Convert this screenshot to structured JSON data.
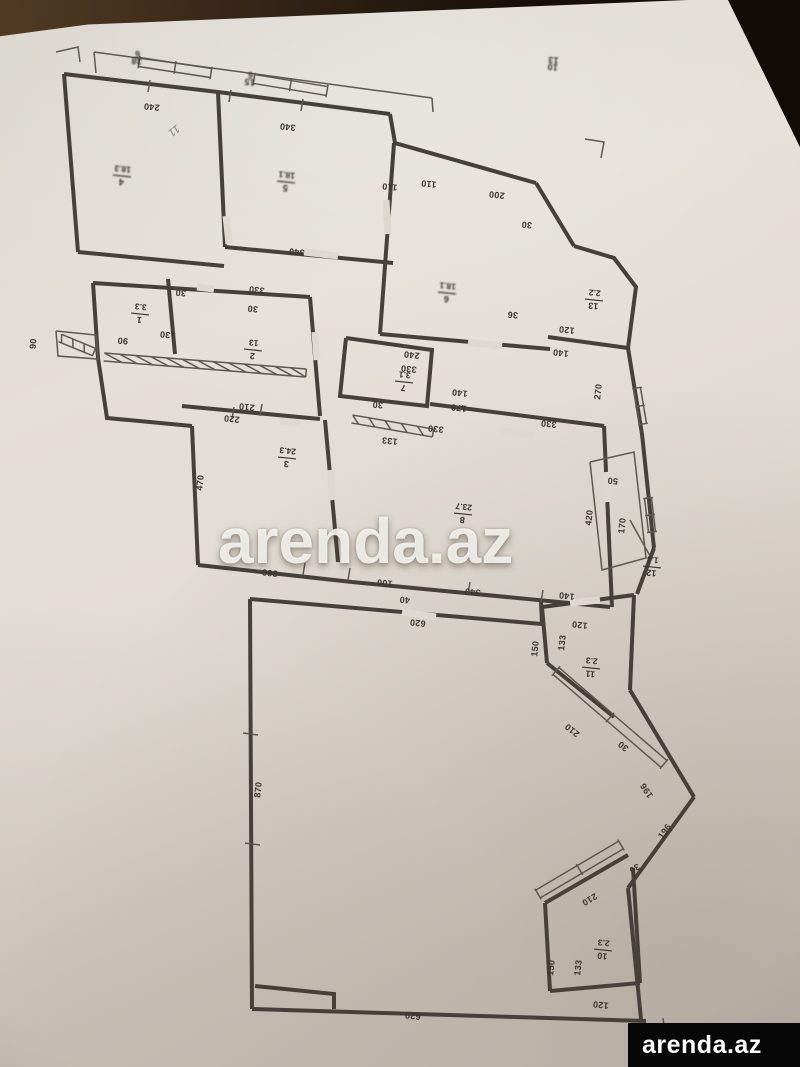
{
  "watermark": {
    "text": "arenda.az"
  },
  "logo": {
    "text": "arenda.az"
  },
  "plan": {
    "ink": "#45413a",
    "walls_thick": [
      [
        [
          64,
          74
        ],
        [
          218,
          92
        ],
        [
          390,
          114
        ]
      ],
      [
        [
          390,
          114
        ],
        [
          395,
          143
        ],
        [
          536,
          183
        ]
      ],
      [
        [
          536,
          183
        ],
        [
          574,
          246
        ]
      ],
      [
        [
          574,
          246
        ],
        [
          614,
          258
        ],
        [
          636,
          287
        ],
        [
          628,
          348
        ],
        [
          548,
          337
        ]
      ],
      [
        [
          628,
          348
        ],
        [
          642,
          434
        ],
        [
          654,
          548
        ]
      ],
      [
        [
          654,
          548
        ],
        [
          637,
          594
        ]
      ],
      [
        [
          218,
          92
        ],
        [
          225,
          247
        ]
      ],
      [
        [
          64,
          74
        ],
        [
          78,
          252
        ]
      ],
      [
        [
          78,
          252
        ],
        [
          224,
          266
        ]
      ],
      [
        [
          93,
          283
        ],
        [
          310,
          297
        ]
      ],
      [
        [
          93,
          283
        ],
        [
          98,
          358
        ]
      ],
      [
        [
          168,
          279
        ],
        [
          175,
          354
        ]
      ],
      [
        [
          310,
          297
        ],
        [
          320,
          416
        ]
      ],
      [
        [
          225,
          247
        ],
        [
          393,
          263
        ]
      ],
      [
        [
          182,
          406
        ],
        [
          320,
          419
        ]
      ],
      [
        [
          394,
          143
        ],
        [
          380,
          334
        ]
      ],
      [
        [
          380,
          334
        ],
        [
          550,
          349
        ]
      ],
      [
        [
          346,
          338
        ],
        [
          432,
          350
        ],
        [
          427,
          406
        ],
        [
          340,
          396
        ],
        [
          346,
          338
        ]
      ],
      [
        [
          430,
          404
        ],
        [
          604,
          426
        ]
      ],
      [
        [
          604,
          426
        ],
        [
          612,
          607
        ]
      ],
      [
        [
          98,
          358
        ],
        [
          107,
          418
        ],
        [
          192,
          426
        ]
      ],
      [
        [
          192,
          426
        ],
        [
          198,
          565
        ]
      ],
      [
        [
          325,
          420
        ],
        [
          338,
          562
        ]
      ],
      [
        [
          198,
          565
        ],
        [
          352,
          582
        ]
      ],
      [
        [
          352,
          582
        ],
        [
          610,
          607
        ]
      ],
      [
        [
          250,
          599
        ],
        [
          542,
          624
        ]
      ],
      [
        [
          542,
          624
        ],
        [
          541,
          601
        ]
      ],
      [
        [
          250,
          599
        ],
        [
          252,
          1009
        ]
      ],
      [
        [
          252,
          1009
        ],
        [
          646,
          1021
        ]
      ],
      [
        [
          255,
          986
        ],
        [
          334,
          994
        ],
        [
          334,
          1009
        ]
      ],
      [
        [
          542,
          607
        ],
        [
          634,
          595
        ]
      ],
      [
        [
          542,
          607
        ],
        [
          547,
          663
        ]
      ],
      [
        [
          547,
          663
        ],
        [
          614,
          717
        ]
      ],
      [
        [
          634,
          595
        ],
        [
          630,
          690
        ]
      ],
      [
        [
          630,
          690
        ],
        [
          694,
          797
        ]
      ],
      [
        [
          694,
          797
        ],
        [
          628,
          888
        ]
      ],
      [
        [
          628,
          888
        ],
        [
          641,
          1019
        ]
      ],
      [
        [
          545,
          903
        ],
        [
          628,
          855
        ]
      ],
      [
        [
          545,
          903
        ],
        [
          550,
          991
        ]
      ],
      [
        [
          550,
          991
        ],
        [
          640,
          983
        ]
      ],
      [
        [
          640,
          983
        ],
        [
          633,
          868
        ]
      ]
    ],
    "walls_thin": [
      [
        [
          94,
          52
        ],
        [
          432,
          98
        ]
      ],
      [
        [
          94,
          52
        ],
        [
          96,
          73
        ]
      ],
      [
        [
          432,
          98
        ],
        [
          433,
          112
        ]
      ],
      [
        [
          590,
          462
        ],
        [
          634,
          452
        ],
        [
          646,
          558
        ],
        [
          602,
          570
        ],
        [
          590,
          462
        ]
      ],
      [
        [
          630,
          520
        ],
        [
          650,
          556
        ]
      ],
      [
        [
          56,
          331
        ],
        [
          96,
          335
        ],
        [
          98,
          359
        ],
        [
          58,
          356
        ],
        [
          56,
          331
        ]
      ],
      [
        [
          56,
          52
        ],
        [
          78,
          47
        ],
        [
          80,
          62
        ]
      ],
      [
        [
          585,
          139
        ],
        [
          604,
          142
        ],
        [
          601,
          158
        ]
      ],
      [
        [
          647,
          1037
        ],
        [
          665,
          1034
        ],
        [
          663,
          1018
        ]
      ],
      [
        [
          150,
          80
        ],
        [
          148,
          92
        ]
      ],
      [
        [
          231,
          90
        ],
        [
          229,
          102
        ]
      ],
      [
        [
          303,
          99
        ],
        [
          301,
          111
        ]
      ],
      [
        [
          470,
          582
        ],
        [
          468,
          594
        ]
      ],
      [
        [
          543,
          590
        ],
        [
          541,
          602
        ]
      ],
      [
        [
          262,
          404
        ],
        [
          260,
          416
        ]
      ],
      [
        [
          234,
          407
        ],
        [
          232,
          419
        ]
      ],
      [
        [
          243,
          733
        ],
        [
          258,
          735
        ]
      ],
      [
        [
          245,
          843
        ],
        [
          260,
          845
        ]
      ],
      [
        [
          350,
          568
        ],
        [
          348,
          580
        ]
      ],
      [
        [
          305,
          563
        ],
        [
          303,
          575
        ]
      ]
    ],
    "gaps": [
      [
        [
          226,
          216
        ],
        [
          229,
          244
        ]
      ],
      [
        [
          386,
          200
        ],
        [
          388,
          234
        ]
      ],
      [
        [
          315,
          332
        ],
        [
          317,
          360
        ]
      ],
      [
        [
          402,
          612
        ],
        [
          436,
          617
        ]
      ],
      [
        [
          304,
          252
        ],
        [
          338,
          256
        ]
      ],
      [
        [
          500,
          430
        ],
        [
          534,
          435
        ]
      ],
      [
        [
          570,
          603
        ],
        [
          600,
          600
        ]
      ],
      [
        [
          468,
          342
        ],
        [
          502,
          346
        ]
      ],
      [
        [
          197,
          287
        ],
        [
          214,
          289
        ]
      ],
      [
        [
          280,
          421
        ],
        [
          300,
          423
        ]
      ],
      [
        [
          330,
          470
        ],
        [
          333,
          500
        ]
      ],
      [
        [
          606,
          472
        ],
        [
          608,
          502
        ]
      ]
    ],
    "bands": [
      {
        "p1": [
          139,
          62
        ],
        "p2": [
          211,
          73
        ],
        "w": 9,
        "ticks": 3,
        "style": "window"
      },
      {
        "p1": [
          254,
          79
        ],
        "p2": [
          327,
          91
        ],
        "w": 9,
        "ticks": 3,
        "style": "window"
      },
      {
        "p1": [
          104,
          357
        ],
        "p2": [
          306,
          373
        ],
        "w": 8,
        "ticks": 14,
        "style": "hatch"
      },
      {
        "p1": [
          352,
          419
        ],
        "p2": [
          433,
          433
        ],
        "w": 8,
        "ticks": 6,
        "style": "hatch"
      },
      {
        "p1": [
          60,
          338
        ],
        "p2": [
          94,
          352
        ],
        "w": 8,
        "ticks": 4,
        "style": "hatch"
      },
      {
        "p1": [
          637,
          388
        ],
        "p2": [
          643,
          424
        ],
        "w": 7,
        "ticks": 3,
        "style": "window"
      },
      {
        "p1": [
          648,
          498
        ],
        "p2": [
          652,
          532
        ],
        "w": 7,
        "ticks": 3,
        "style": "window"
      },
      {
        "p1": [
          556,
          671
        ],
        "p2": [
          664,
          764
        ],
        "w": 9,
        "ticks": 3,
        "style": "window"
      },
      {
        "p1": [
          538,
          894
        ],
        "p2": [
          621,
          845
        ],
        "w": 9,
        "ticks": 3,
        "style": "window"
      }
    ],
    "rooms": [
      {
        "num": "4",
        "area": "18.3",
        "x": 122,
        "y": 176,
        "r": 186,
        "blur": true
      },
      {
        "num": "5",
        "area": "18.1",
        "x": 286,
        "y": 182,
        "r": 186,
        "blur": true
      },
      {
        "num": "6",
        "area": "18.1",
        "x": 447,
        "y": 293,
        "r": 186,
        "blur": true
      },
      {
        "num": "13",
        "area": "2.2",
        "x": 594,
        "y": 300,
        "r": 186,
        "blur": false
      },
      {
        "num": "1",
        "area": "3.3",
        "x": 140,
        "y": 314,
        "r": 186,
        "blur": false
      },
      {
        "num": "2",
        "area": "13",
        "x": 253,
        "y": 350,
        "r": 186,
        "blur": false
      },
      {
        "num": "3",
        "area": "24.3",
        "x": 287,
        "y": 458,
        "r": 186,
        "blur": false
      },
      {
        "num": "7",
        "area": "3.1",
        "x": 404,
        "y": 382,
        "r": 186,
        "blur": false
      },
      {
        "num": "8",
        "area": "23.7",
        "x": 463,
        "y": 514,
        "r": 186,
        "blur": false
      },
      {
        "num": "12",
        "area": "1.4",
        "x": 652,
        "y": 567,
        "r": 186,
        "blur": false
      },
      {
        "num": "11",
        "area": "2.3",
        "x": 591,
        "y": 668,
        "r": 186,
        "blur": false
      },
      {
        "num": "10",
        "area": "2.3",
        "x": 603,
        "y": 950,
        "r": 186,
        "blur": false
      }
    ],
    "dims": [
      {
        "t": "240",
        "x": 152,
        "y": 104,
        "r": 186
      },
      {
        "t": "340",
        "x": 288,
        "y": 124,
        "r": 186
      },
      {
        "t": "110",
        "x": 390,
        "y": 184,
        "r": 186
      },
      {
        "t": "110",
        "x": 429,
        "y": 181,
        "r": 186
      },
      {
        "t": "200",
        "x": 497,
        "y": 192,
        "r": 186
      },
      {
        "t": "30",
        "x": 527,
        "y": 222,
        "r": 186
      },
      {
        "t": "36",
        "x": 513,
        "y": 312,
        "r": 186
      },
      {
        "t": "120",
        "x": 567,
        "y": 327,
        "r": 186
      },
      {
        "t": "140",
        "x": 561,
        "y": 350,
        "r": 186
      },
      {
        "t": "270",
        "x": 601,
        "y": 392,
        "r": 276
      },
      {
        "t": "330",
        "x": 549,
        "y": 421,
        "r": 186
      },
      {
        "t": "340",
        "x": 297,
        "y": 249,
        "r": 186
      },
      {
        "t": "330",
        "x": 257,
        "y": 287,
        "r": 186
      },
      {
        "t": "30",
        "x": 181,
        "y": 290,
        "r": 186
      },
      {
        "t": "30",
        "x": 253,
        "y": 306,
        "r": 186
      },
      {
        "t": "90",
        "x": 123,
        "y": 338,
        "r": 186
      },
      {
        "t": "130",
        "x": 168,
        "y": 332,
        "r": 186
      },
      {
        "t": "90",
        "x": 36,
        "y": 344,
        "r": 276
      },
      {
        "t": "210",
        "x": 247,
        "y": 404,
        "r": 186
      },
      {
        "t": "220",
        "x": 232,
        "y": 416,
        "r": 186
      },
      {
        "t": "470",
        "x": 203,
        "y": 483,
        "r": 276
      },
      {
        "t": "240",
        "x": 412,
        "y": 352,
        "r": 186
      },
      {
        "t": "330",
        "x": 409,
        "y": 366,
        "r": 186
      },
      {
        "t": "30",
        "x": 378,
        "y": 402,
        "r": 186
      },
      {
        "t": "140",
        "x": 460,
        "y": 390,
        "r": 186
      },
      {
        "t": "170",
        "x": 459,
        "y": 405,
        "r": 186
      },
      {
        "t": "133",
        "x": 390,
        "y": 438,
        "r": 186
      },
      {
        "t": "330",
        "x": 436,
        "y": 426,
        "r": 186
      },
      {
        "t": "100",
        "x": 385,
        "y": 580,
        "r": 186
      },
      {
        "t": "40",
        "x": 405,
        "y": 597,
        "r": 186
      },
      {
        "t": "340",
        "x": 473,
        "y": 589,
        "r": 186
      },
      {
        "t": "140",
        "x": 567,
        "y": 593,
        "r": 186
      },
      {
        "t": "360",
        "x": 270,
        "y": 570,
        "r": 186
      },
      {
        "t": "620",
        "x": 418,
        "y": 620,
        "r": 186
      },
      {
        "t": "50",
        "x": 613,
        "y": 478,
        "r": 186
      },
      {
        "t": "420",
        "x": 592,
        "y": 518,
        "r": 276
      },
      {
        "t": "170",
        "x": 625,
        "y": 526,
        "r": 276
      },
      {
        "t": "120",
        "x": 580,
        "y": 622,
        "r": 186
      },
      {
        "t": "133",
        "x": 565,
        "y": 643,
        "r": 276
      },
      {
        "t": "150",
        "x": 538,
        "y": 649,
        "r": 276
      },
      {
        "t": "210",
        "x": 574,
        "y": 728,
        "r": 219
      },
      {
        "t": "30",
        "x": 625,
        "y": 744,
        "r": 219
      },
      {
        "t": "196",
        "x": 649,
        "y": 789,
        "r": 237
      },
      {
        "t": "196",
        "x": 667,
        "y": 833,
        "r": 306
      },
      {
        "t": "210",
        "x": 588,
        "y": 897,
        "r": 149
      },
      {
        "t": "30",
        "x": 633,
        "y": 866,
        "r": 149
      },
      {
        "t": "870",
        "x": 261,
        "y": 790,
        "r": 276
      },
      {
        "t": "150",
        "x": 554,
        "y": 968,
        "r": 276
      },
      {
        "t": "133",
        "x": 581,
        "y": 968,
        "r": 276
      },
      {
        "t": "120",
        "x": 601,
        "y": 1002,
        "r": 186
      },
      {
        "t": "620",
        "x": 413,
        "y": 1013,
        "r": 186
      }
    ],
    "tiny_fractions": [
      {
        "num": "38",
        "den": "6",
        "x": 137,
        "y": 57,
        "r": 186
      },
      {
        "num": "15",
        "den": "6",
        "x": 250,
        "y": 78,
        "r": 186
      },
      {
        "num": "10",
        "den": "13",
        "x": 553,
        "y": 63,
        "r": 186
      }
    ],
    "scribbles": [
      {
        "t": "11",
        "x": 172,
        "y": 128,
        "r": 140
      }
    ]
  }
}
